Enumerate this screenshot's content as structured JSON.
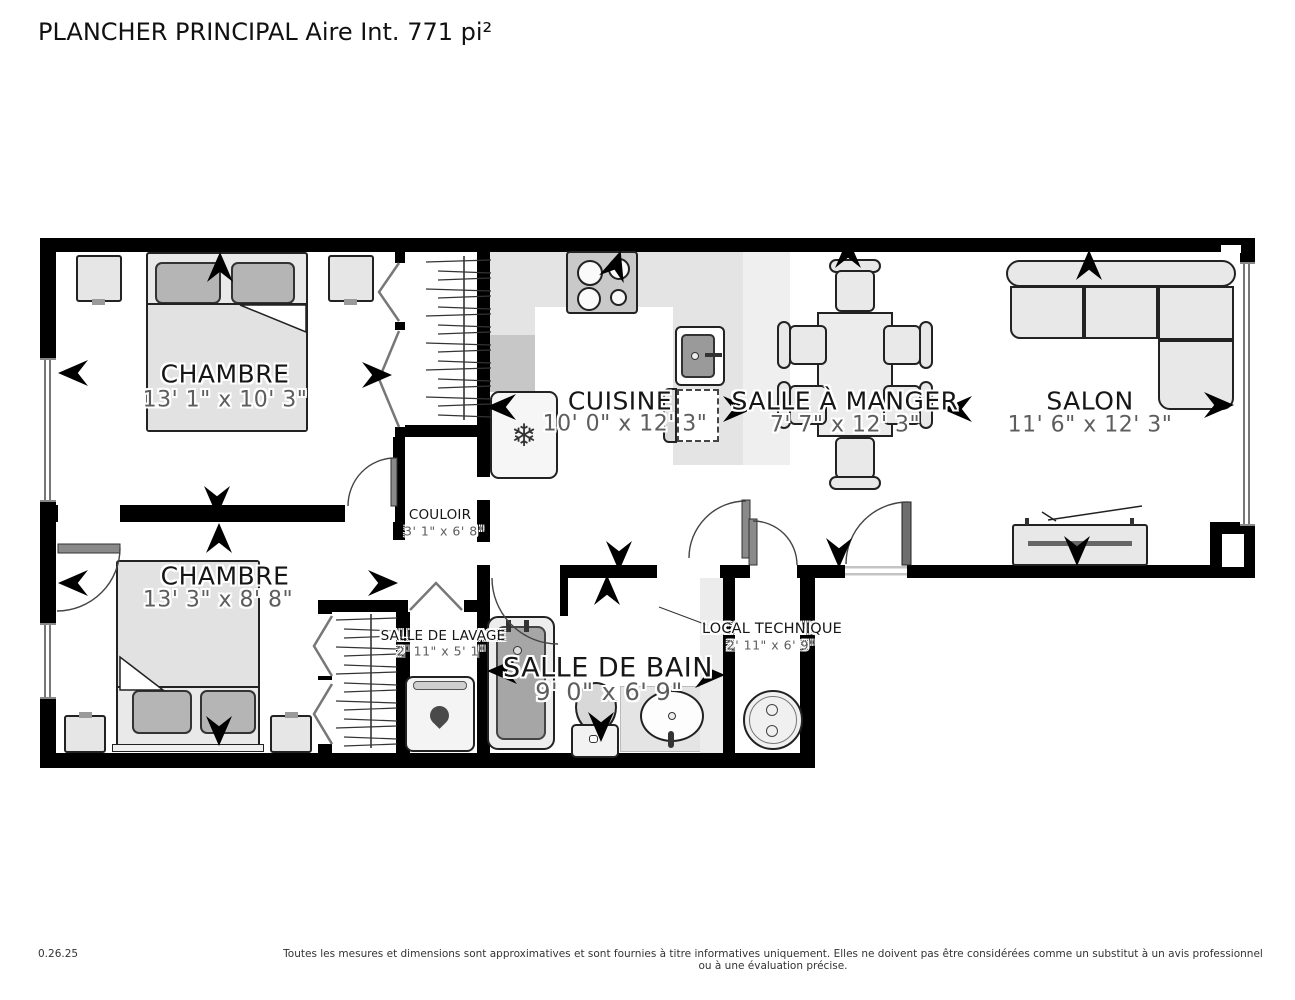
{
  "title": "PLANCHER PRINCIPAL Aire Int. 771 pi²",
  "rooms": {
    "chambre1": {
      "label": "CHAMBRE",
      "dims": "13' 1\" x 10' 3\""
    },
    "cuisine": {
      "label": "CUISINE",
      "dims": "10' 0\" x 12' 3\""
    },
    "salle_a_manger": {
      "label": "SALLE À MANGER",
      "dims": "7' 7\" x 12' 3\""
    },
    "salon": {
      "label": "SALON",
      "dims": "11' 6\" x 12' 3\""
    },
    "couloir": {
      "label": "COULOIR",
      "dims": "3' 1\" x 6' 8\""
    },
    "chambre2": {
      "label": "CHAMBRE",
      "dims": "13' 3\" x 8' 8\""
    },
    "salle_de_lavage": {
      "label": "SALLE DE LAVAGE",
      "dims": "2' 11\" x 5' 1\""
    },
    "salle_de_bain": {
      "label": "SALLE DE BAIN",
      "dims": "9' 0\" x 6' 9\""
    },
    "local_technique": {
      "label": "LOCAL TECHNIQUE",
      "dims": "2' 11\" x 6' 9\""
    }
  },
  "icons": {
    "snowflake": "❄"
  },
  "footer": {
    "version": "0.26.25",
    "disclaimer": "Toutes les mesures et dimensions sont approximatives et sont fournies à titre informatives uniquement. Elles ne doivent pas être considérées comme un substitut à un avis professionnel ou à une évaluation précise."
  },
  "colors": {
    "wall": "#000000",
    "floor": "#ffffff",
    "counter": "#e4e4e4",
    "counter_dark": "#c7c7c7",
    "furniture": "#e8e8e8",
    "fixture_dark": "#a6a6a6",
    "pillow": "#b5b5b5",
    "dim_text": "#5d5d5d"
  }
}
